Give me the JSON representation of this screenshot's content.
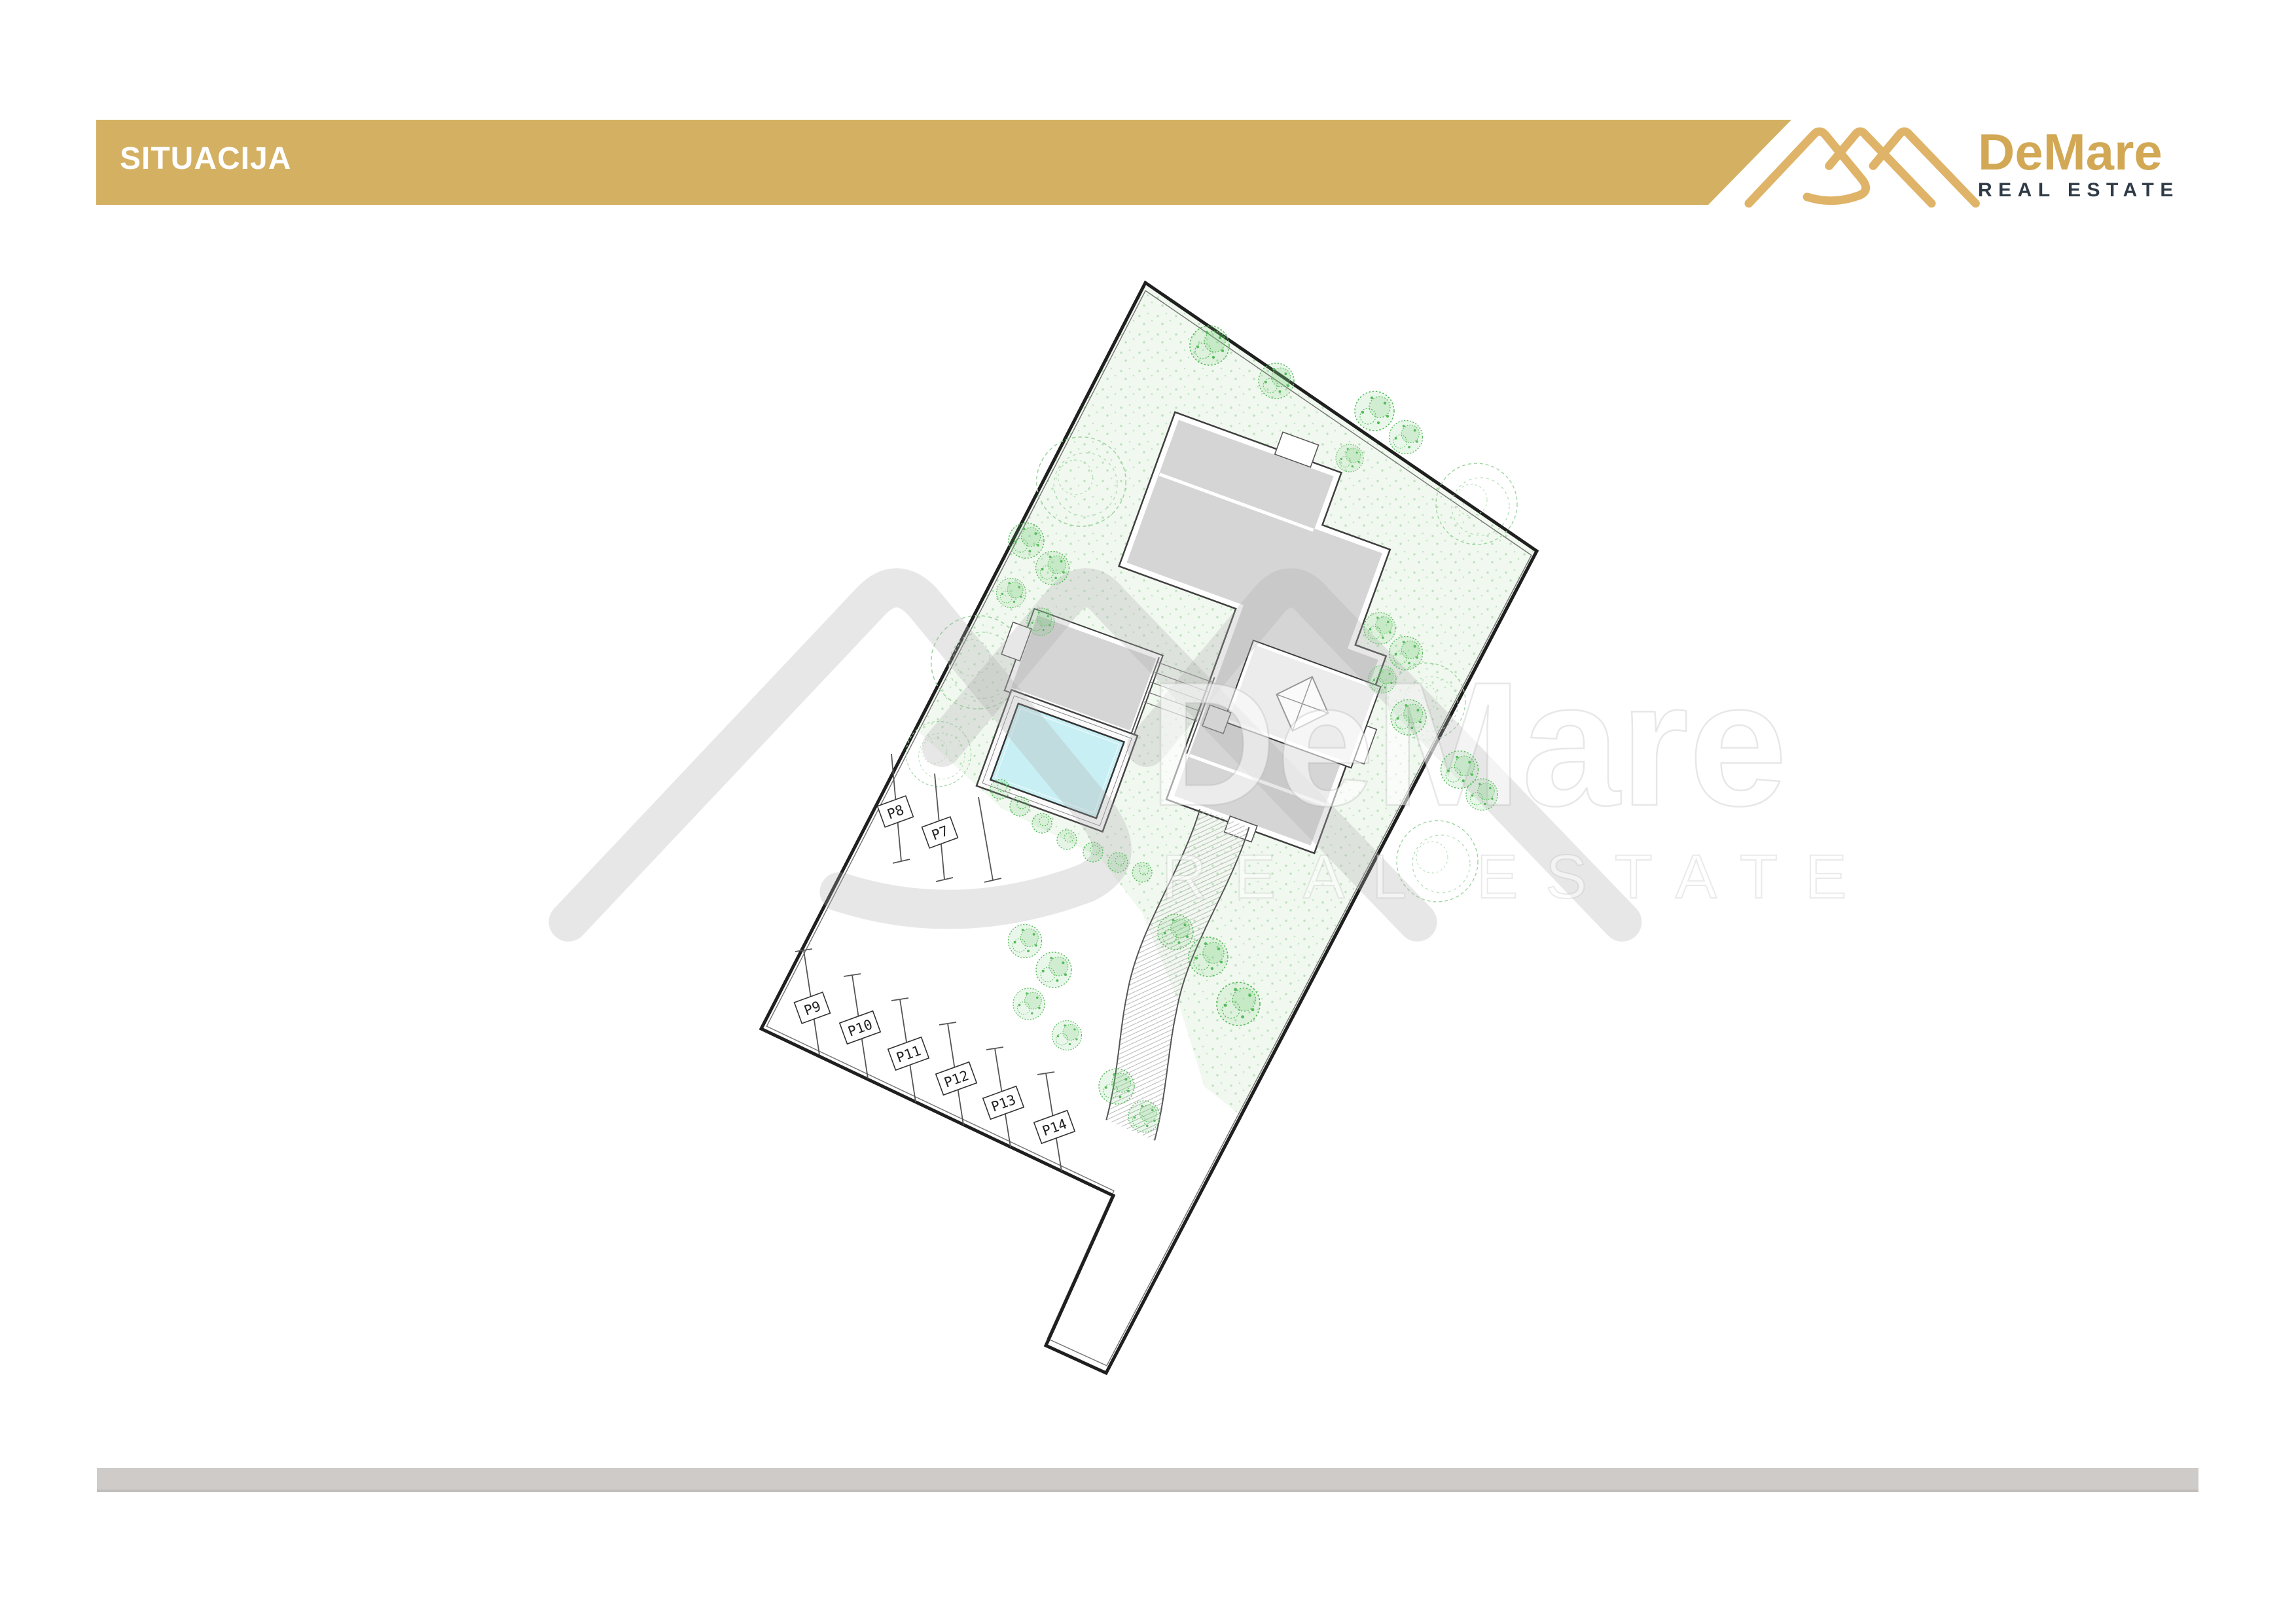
{
  "header": {
    "title": "SITUACIJA",
    "bar_color": "#D4B063"
  },
  "logo": {
    "name": "DeMare",
    "subtitle": "REAL ESTATE",
    "glyph_color": "#DFB468",
    "name_color": "#D2A855",
    "subtitle_color": "#2E3A45"
  },
  "watermark": {
    "name": "DeMare",
    "subtitle": "REAL ESTATE"
  },
  "plan": {
    "parking": [
      {
        "label": "P7"
      },
      {
        "label": "P8"
      },
      {
        "label": "P9"
      },
      {
        "label": "P10"
      },
      {
        "label": "P11"
      },
      {
        "label": "P12"
      },
      {
        "label": "P13"
      },
      {
        "label": "P14"
      }
    ],
    "colors": {
      "building_fill": "#D5D5D5",
      "wall_white": "#FFFFFF",
      "outline_dark": "#3F3F3F",
      "pool_water": "#C8EFF4",
      "boundary": "#1F1F1F",
      "yard_green": "#F1F8EF",
      "tree_green": "#57BB5C",
      "footer_bar": "#CECBC8"
    }
  }
}
